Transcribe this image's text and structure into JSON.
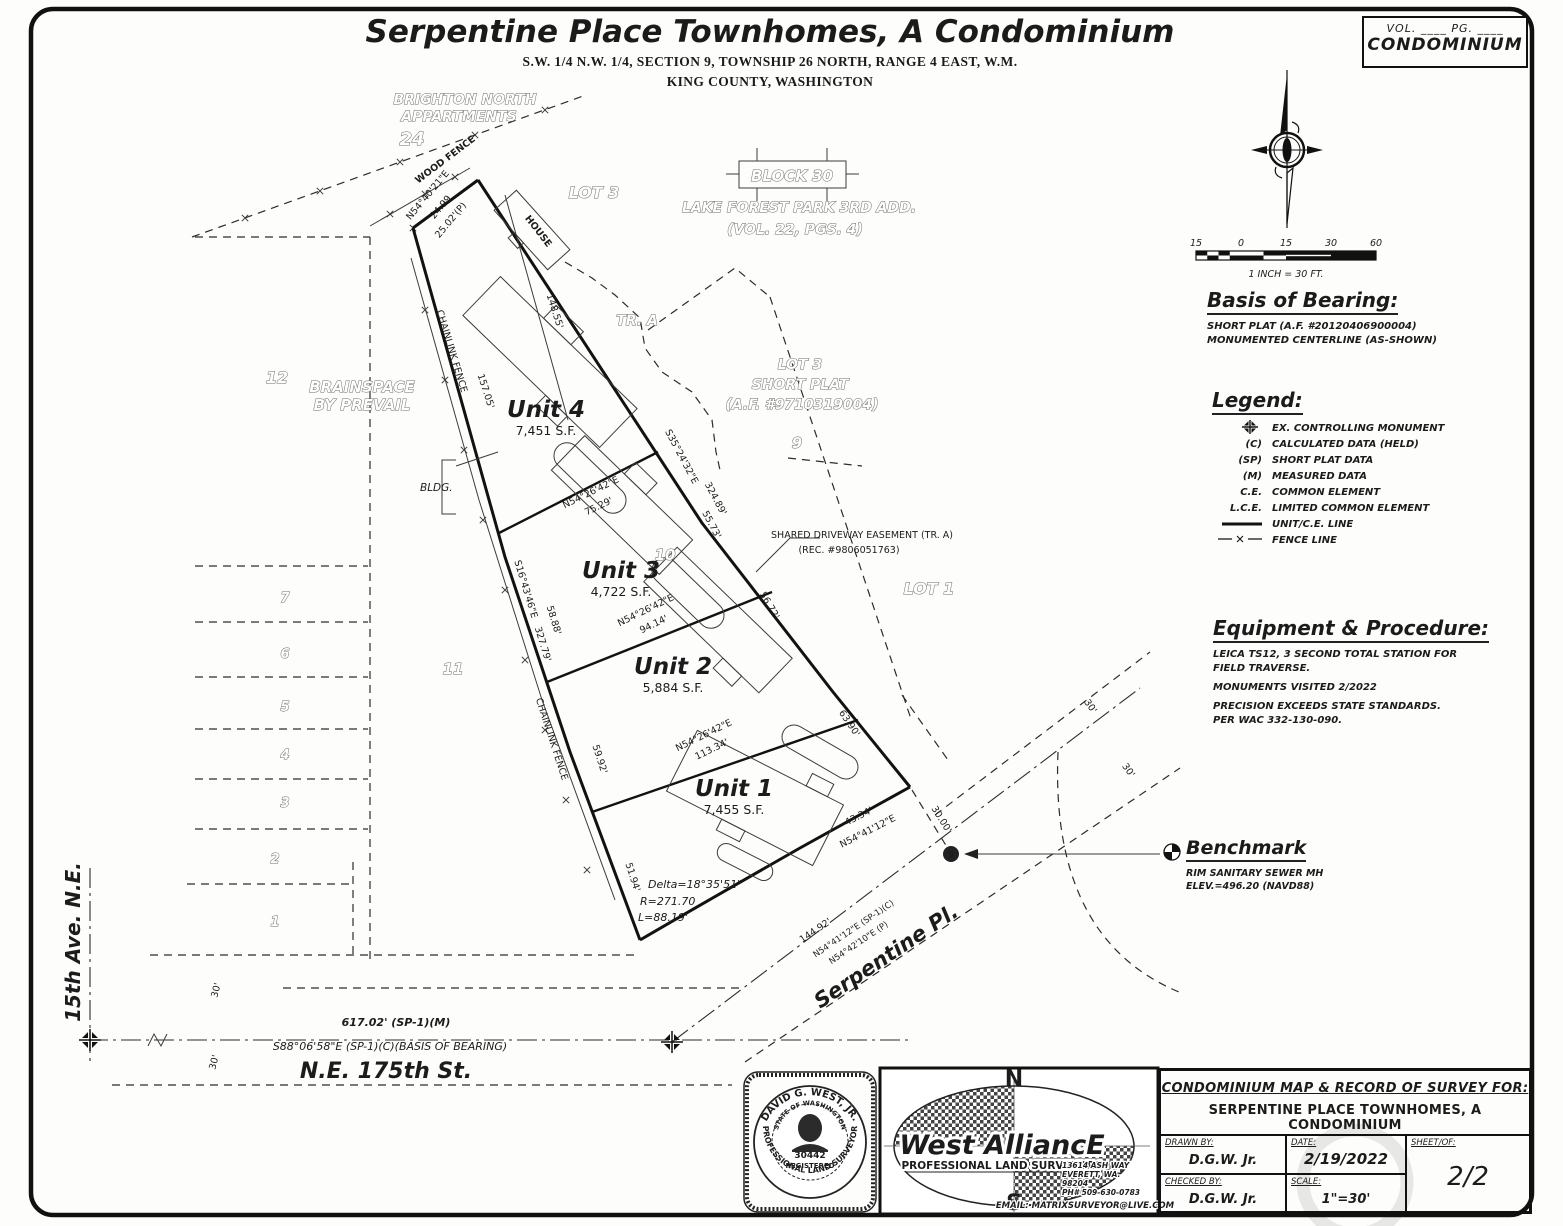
{
  "header": {
    "title": "Serpentine Place Townhomes, A Condominium",
    "sub1": "S.W. 1/4 N.W. 1/4, SECTION 9, TOWNSHIP 26 NORTH, RANGE 4 EAST, W.M.",
    "sub2": "KING COUNTY, WASHINGTON"
  },
  "vol_box": {
    "line1": "VOL. ____    PG. ____",
    "line2": "CONDOMINIUM"
  },
  "scale_bar": {
    "t1": "15",
    "t2": "0",
    "t3": "15",
    "t4": "30",
    "t5": "60",
    "caption": "1 INCH = 30 FT."
  },
  "basis": {
    "title": "Basis of Bearing:",
    "l1": "SHORT PLAT (A.F. #20120406900004)",
    "l2": "MONUMENTED CENTERLINE (AS-SHOWN)"
  },
  "legend": {
    "title": "Legend:",
    "items": [
      {
        "sym": "",
        "label": "EX. CONTROLLING MONUMENT"
      },
      {
        "sym": "(C)",
        "label": "CALCULATED DATA (HELD)"
      },
      {
        "sym": "(SP)",
        "label": "SHORT PLAT DATA"
      },
      {
        "sym": "(M)",
        "label": "MEASURED DATA"
      },
      {
        "sym": "C.E.",
        "label": "COMMON ELEMENT"
      },
      {
        "sym": "L.C.E.",
        "label": "LIMITED COMMON ELEMENT"
      },
      {
        "sym": "",
        "label": "UNIT/C.E. LINE"
      },
      {
        "sym": "",
        "label": "FENCE LINE"
      }
    ]
  },
  "equipment": {
    "title": "Equipment & Procedure:",
    "l1": "LEICA TS12, 3 SECOND TOTAL STATION FOR",
    "l2": "FIELD TRAVERSE.",
    "l3": "MONUMENTS VISITED 2/2022",
    "l4": "PRECISION EXCEEDS STATE STANDARDS.",
    "l5": "PER WAC 332-130-090."
  },
  "benchmark": {
    "title": "Benchmark",
    "l1": "RIM SANITARY SEWER MH",
    "l2": "ELEV.=496.20 (NAVD88)"
  },
  "map": {
    "manhole": "S",
    "brighton1": "BRIGHTON NORTH",
    "brighton2": "APPARTMENTS",
    "n24": "24",
    "wood_fence": "WOOD FENCE",
    "brg_tip": "N54°40'21\"E",
    "d2499": "24.99",
    "d2502": "25.02'(P)",
    "lot3_top": "LOT 3",
    "house": "HOUSE",
    "block30": "BLOCK 30",
    "lfp": "LAKE FOREST PARK 3RD ADD.",
    "lfp_vol": "(VOL. 22, PGS. 4)",
    "tr_a": "TR. A",
    "lot3_sp1": "LOT 3",
    "lot3_sp2": "SHORT PLAT",
    "lot3_sp3": "(A.F. #9710319004)",
    "n9": "9",
    "n10": "10",
    "n11": "11",
    "n12": "12",
    "brain1": "BRAINSPACE",
    "brain2": "BY PREVAIL",
    "lot1": "LOT 1",
    "easement1": "SHARED DRIVEWAY EASEMENT (TR. A)",
    "easement2": "(REC. #9806051763)",
    "unit4": "Unit 4",
    "unit4_sf": "7,451 S.F.",
    "unit3": "Unit 3",
    "unit3_sf": "4,722 S.F.",
    "unit2": "Unit 2",
    "unit2_sf": "5,884 S.F.",
    "unit1": "Unit 1",
    "unit1_sf": "7,455 S.F.",
    "bldg": "BLDG.",
    "d14855": "148.55'",
    "d15705": "157.05'",
    "chainlink": "CHAINLINK FENCE",
    "brg_1643": "S16°43'46\"E",
    "d32779": "327.79'",
    "d5888": "58.88'",
    "d5992": "59.92'",
    "d5194": "51.94'",
    "brg_3524": "S35°24'32\"E",
    "d32489": "324.89'",
    "d5573": "55.73'",
    "brg_5426": "N54°26'42\"E",
    "d7529": "75.29'",
    "d9414": "94.14'",
    "d11334": "113.34'",
    "d5672": "56.72'",
    "d6390": "63.90'",
    "d4334": "43.34'",
    "brg_5441": "N54°41'12\"E",
    "d3000": "30.00'",
    "n7": "7",
    "n6": "6",
    "n5": "5",
    "n4": "4",
    "n3": "3",
    "n2": "2",
    "n1": "1",
    "delta": "Delta=18°35'51\"",
    "radius": "R=271.70",
    "arc_len": "L=88.19'",
    "d14492": "144.92'",
    "brg_5441sp": "N54°41'12\"E (SP-1)(C)",
    "brg_5442": "N54°42'10\"E (P)",
    "serpentine": "Serpentine Pl.",
    "d30": "30'",
    "d61702": "617.02' (SP-1)(M)",
    "brg_8806": "S88°06'58\"E (SP-1)(C)(BASIS OF BEARING)",
    "ne175": "N.E. 175th St.",
    "ave15": "15th Ave. N.E."
  },
  "title_block": {
    "heading1": "CONDOMINIUM MAP & RECORD OF SURVEY FOR:",
    "heading2": "SERPENTINE PLACE TOWNHOMES, A CONDOMINIUM",
    "drawn_label": "DRAWN BY:",
    "drawn": "D.G.W. Jr.",
    "checked_label": "CHECKED BY:",
    "checked": "D.G.W. Jr.",
    "date_label": "DATE:",
    "date": "2/19/2022",
    "scale_label": "SCALE:",
    "scale": "1\"=30'",
    "sheet_label": "SHEET/OF:",
    "sheet": "2/2"
  },
  "stamp": {
    "arc_top": "DAVID G. WEST, JR.",
    "arc_bottom": "PROFESSIONAL LAND SURVEYOR",
    "inner_arc": "STATE OF WASHINGTON",
    "number": "30442",
    "registered": "REGISTERED"
  },
  "logo": {
    "n": "N",
    "s": "S",
    "name": "West AlliancE",
    "tagline": "PROFESSIONAL LAND SURVEYORS",
    "addr1": "13614 ASH WAY",
    "addr2": "EVERETT, WA.",
    "addr3": "98204",
    "addr4": "PH# 509-630-0783",
    "email": "EMAIL: MATRIXSURVEYOR@LIVE.COM"
  }
}
